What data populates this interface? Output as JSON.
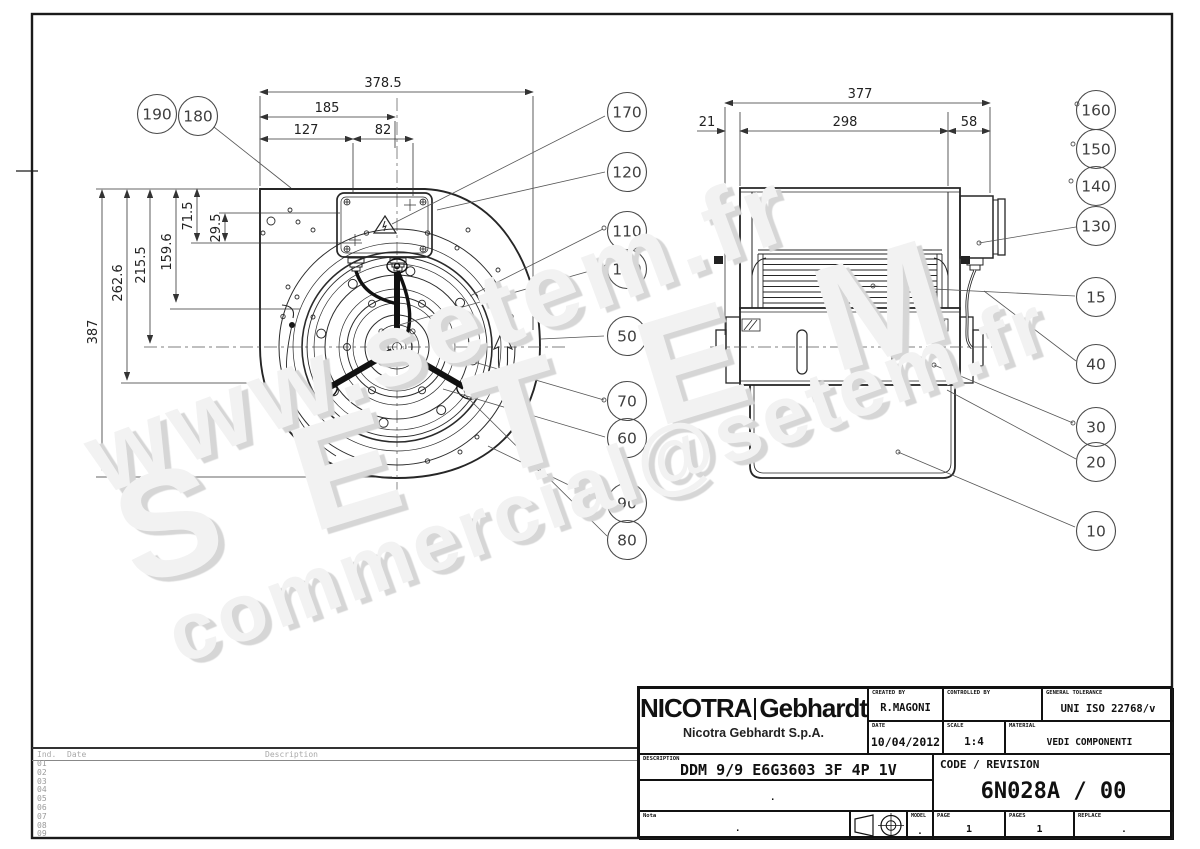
{
  "watermarks": {
    "line1": "www.setem.fr",
    "line2": "SETEM",
    "line3": "commercial@setem.fr"
  },
  "left_view": {
    "top_dims": [
      "378.5",
      "185",
      "127",
      "82"
    ],
    "side_dims": [
      "387",
      "262.6",
      "215.5",
      "159.6",
      "71.5",
      "29.5"
    ]
  },
  "right_view": {
    "top_dims": [
      "377",
      "21",
      "298",
      "58"
    ]
  },
  "balloons": {
    "top_left": [
      "190",
      "180"
    ],
    "middle": [
      "170",
      "120",
      "110",
      "100",
      "50",
      "70",
      "60",
      "90",
      "80"
    ],
    "right": [
      "160",
      "150",
      "140",
      "130",
      "15",
      "40",
      "30",
      "20",
      "10"
    ]
  },
  "revision_table": {
    "headers": [
      "Ind.",
      "Date",
      "Description"
    ],
    "rows": [
      "01",
      "02",
      "03",
      "04",
      "05",
      "06",
      "07",
      "08",
      "09"
    ]
  },
  "title_block": {
    "brand_primary": "NICOTRA",
    "brand_secondary": "Gebhardt",
    "company": "Nicotra Gebhardt S.p.A.",
    "created_by_label": "CREATED BY",
    "created_by": "R.MAGONI",
    "controlled_by_label": "CONTROLLED BY",
    "tolerance_label": "GENERAL TOLERANCE",
    "tolerance": "UNI ISO 22768/v",
    "date_label": "DATE",
    "date": "10/04/2012",
    "scale_label": "SCALE",
    "scale": "1:4",
    "material_label": "MATERIAL",
    "material": "VEDI COMPONENTI",
    "description_label": "DESCRIPTION",
    "description": "DDM 9/9 E6G3603 3F 4P 1V +SCT",
    "code_revision_label": "CODE / REVISION",
    "code_revision": "6N028A / 00",
    "note_label": "Nota",
    "model_label": "MODEL",
    "page_label": "PAGE",
    "page": "1",
    "pages_label": "PAGES",
    "pages": "1",
    "replace_label": "REPLACE",
    "dot": "."
  }
}
